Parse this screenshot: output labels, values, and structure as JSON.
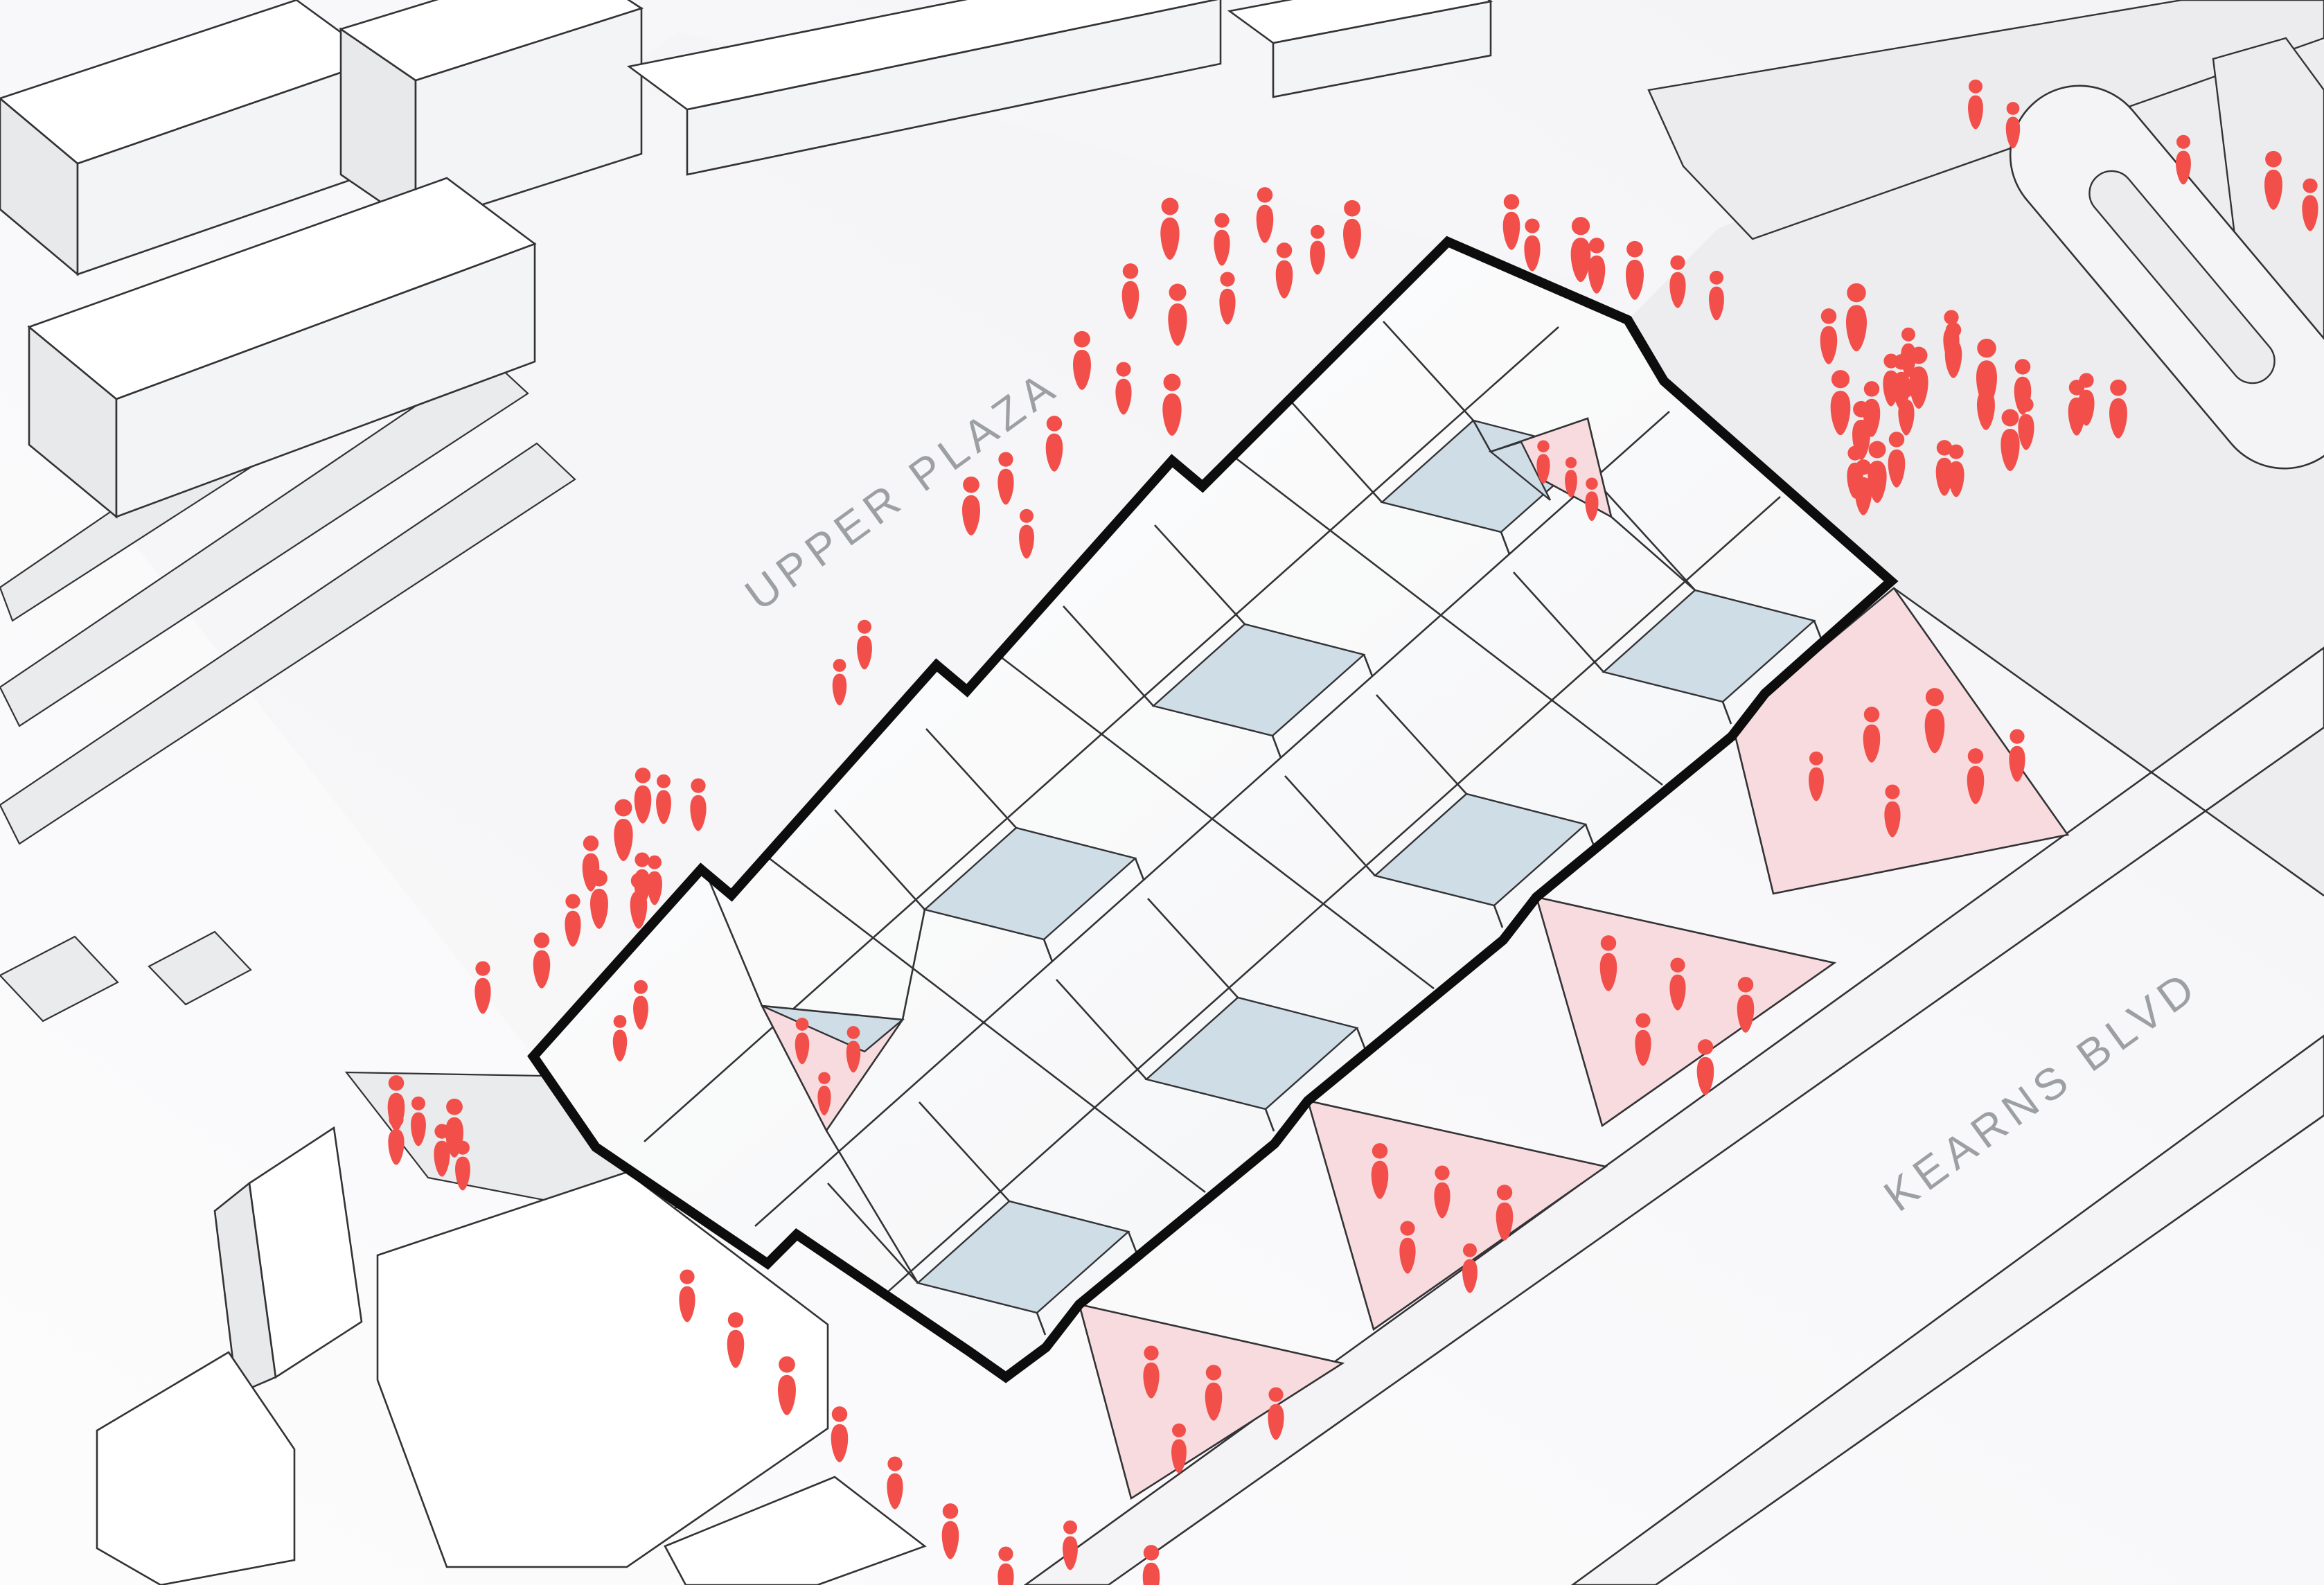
{
  "page": {
    "title": "Axonometric Site Plan Diagram"
  },
  "labels": {
    "upper_plaza": "UPPER PLAZA",
    "kearns_blvd": "KEARNS BLVD"
  },
  "colors": {
    "background": "#fbfbfc",
    "bg-shade": "#f3f3f5",
    "upper-plaza-ground": "#f4f4f6",
    "east-plaza-ground": "#ededef",
    "road-fill": "#f4f4f6",
    "context-fill": "#ececee",
    "context-roof": "#ffffff",
    "context-front": "#f3f4f6",
    "context-side": "#e8e9eb",
    "strip-gray": "#eaebed",
    "outline-black": "#0d0d0d",
    "line-dark": "#333336",
    "roof-white": "#ffffff",
    "roof-shade": "#f2f3f5",
    "skylight-blue": "#cfdde6",
    "courtyard-pink": "#f8dbde",
    "people-red": "#f24f4a",
    "label-gray": "#9da0a3"
  },
  "icons": {
    "person": "person-icon"
  },
  "people": {
    "zones": [
      {
        "name": "upper-plaza-crowd",
        "positions": [
          [
            1689,
            332,
            1
          ],
          [
            1764,
            347,
            0.85
          ],
          [
            1826,
            312,
            0.9
          ],
          [
            1952,
            333,
            0.95
          ],
          [
            1632,
            422,
            0.9
          ],
          [
            1700,
            456,
            1
          ],
          [
            1772,
            432,
            0.85
          ],
          [
            1854,
            392,
            0.9
          ],
          [
            1902,
            362,
            0.8
          ],
          [
            1562,
            522,
            0.95
          ],
          [
            1622,
            562,
            0.85
          ],
          [
            1692,
            586,
            1
          ],
          [
            1522,
            642,
            0.9
          ],
          [
            1452,
            692,
            0.85
          ],
          [
            1402,
            732,
            0.95
          ],
          [
            1482,
            772,
            0.8
          ]
        ]
      },
      {
        "name": "ne-walkway",
        "positions": [
          [
            2182,
            322,
            0.9
          ],
          [
            2212,
            355,
            0.85
          ],
          [
            2282,
            362,
            1.05
          ],
          [
            2305,
            385,
            0.9
          ],
          [
            2360,
            392,
            0.95
          ],
          [
            2422,
            408,
            0.85
          ],
          [
            2478,
            428,
            0.8
          ]
        ]
      },
      {
        "name": "east-plaza-crowd",
        "positions": [
          [
            2640,
            487,
            0.9
          ],
          [
            2680,
            460,
            1.1
          ],
          [
            2657,
            583,
            1.05
          ],
          [
            2702,
            592,
            0.9
          ],
          [
            2687,
            623,
            0.95
          ],
          [
            2730,
            550,
            0.85
          ],
          [
            2745,
            553,
            0.9
          ],
          [
            2770,
            547,
            1
          ],
          [
            2752,
            592,
            0.85
          ],
          [
            2738,
            665,
            0.9
          ],
          [
            2710,
            683,
            1
          ],
          [
            2678,
            683,
            0.85
          ],
          [
            2690,
            705,
            0.9
          ],
          [
            2817,
            487,
            0.85
          ],
          [
            2820,
            507,
            0.9
          ],
          [
            2868,
            540,
            1.1
          ],
          [
            2867,
            580,
            0.95
          ],
          [
            2920,
            560,
            0.9
          ],
          [
            2925,
            613,
            0.85
          ],
          [
            2902,
            637,
            1
          ],
          [
            2807,
            677,
            0.9
          ],
          [
            2824,
            681,
            0.85
          ],
          [
            2998,
            590,
            0.9
          ],
          [
            3012,
            578,
            0.85
          ],
          [
            3058,
            592,
            0.95
          ],
          [
            2755,
            510,
            0.8
          ]
        ]
      },
      {
        "name": "far-right",
        "positions": [
          [
            3282,
            262,
            0.95
          ],
          [
            3335,
            297,
            0.85
          ],
          [
            3152,
            232,
            0.8
          ],
          [
            2852,
            152,
            0.8
          ],
          [
            2906,
            182,
            0.75
          ]
        ]
      },
      {
        "name": "west-walkway",
        "positions": [
          [
            928,
            1150,
            0.9
          ],
          [
            958,
            1155,
            0.8
          ],
          [
            1008,
            1163,
            0.85
          ],
          [
            900,
            1200,
            1
          ],
          [
            853,
            1248,
            0.9
          ],
          [
            927,
            1270,
            0.85
          ],
          [
            945,
            1272,
            0.8
          ],
          [
            922,
            1302,
            0.9
          ],
          [
            865,
            1300,
            0.95
          ],
          [
            827,
            1330,
            0.85
          ],
          [
            782,
            1388,
            0.9
          ],
          [
            697,
            1427,
            0.85
          ],
          [
            1248,
            932,
            0.8
          ],
          [
            1212,
            986,
            0.75
          ]
        ]
      },
      {
        "name": "west-entry",
        "positions": [
          [
            572,
            1594,
            0.9
          ],
          [
            604,
            1620,
            0.8
          ],
          [
            572,
            1645,
            0.85
          ],
          [
            656,
            1630,
            0.95
          ],
          [
            638,
            1662,
            0.85
          ],
          [
            668,
            1684,
            0.8
          ],
          [
            925,
            1452,
            0.8
          ],
          [
            895,
            1500,
            0.75
          ]
        ]
      },
      {
        "name": "south-walkway",
        "positions": [
          [
            992,
            1872,
            0.85
          ],
          [
            1062,
            1936,
            0.9
          ],
          [
            1136,
            2002,
            0.95
          ],
          [
            1212,
            2072,
            0.9
          ],
          [
            1292,
            2142,
            0.85
          ],
          [
            1372,
            2212,
            0.9
          ],
          [
            1452,
            2272,
            0.85
          ],
          [
            1545,
            2232,
            0.8
          ],
          [
            1662,
            2272,
            0.9
          ]
        ]
      },
      {
        "name": "courtyard-west",
        "positions": [
          [
            1158,
            1504,
            0.75
          ],
          [
            1232,
            1516,
            0.75
          ],
          [
            1190,
            1580,
            0.7
          ]
        ]
      },
      {
        "name": "courtyard-east",
        "positions": [
          [
            2228,
            668,
            0.7
          ],
          [
            2268,
            690,
            0.65
          ],
          [
            2298,
            722,
            0.7
          ]
        ]
      },
      {
        "name": "entry-triangle-east",
        "positions": [
          [
            2702,
            1062,
            0.9
          ],
          [
            2793,
            1042,
            1.05
          ],
          [
            2852,
            1122,
            0.9
          ],
          [
            2732,
            1172,
            0.85
          ],
          [
            2622,
            1122,
            0.8
          ],
          [
            2912,
            1092,
            0.85
          ]
        ]
      },
      {
        "name": "entry-triangle-2",
        "positions": [
          [
            2322,
            1392,
            0.9
          ],
          [
            2422,
            1422,
            0.85
          ],
          [
            2520,
            1452,
            0.9
          ],
          [
            2372,
            1502,
            0.85
          ],
          [
            2462,
            1542,
            0.9
          ]
        ]
      },
      {
        "name": "entry-triangle-1",
        "positions": [
          [
            1992,
            1692,
            0.9
          ],
          [
            2082,
            1722,
            0.85
          ],
          [
            2172,
            1752,
            0.9
          ],
          [
            2032,
            1802,
            0.85
          ],
          [
            2122,
            1832,
            0.8
          ]
        ]
      },
      {
        "name": "entry-triangle-0",
        "positions": [
          [
            1662,
            1982,
            0.85
          ],
          [
            1752,
            2012,
            0.9
          ],
          [
            1842,
            2042,
            0.85
          ],
          [
            1702,
            2092,
            0.8
          ]
        ]
      }
    ]
  }
}
